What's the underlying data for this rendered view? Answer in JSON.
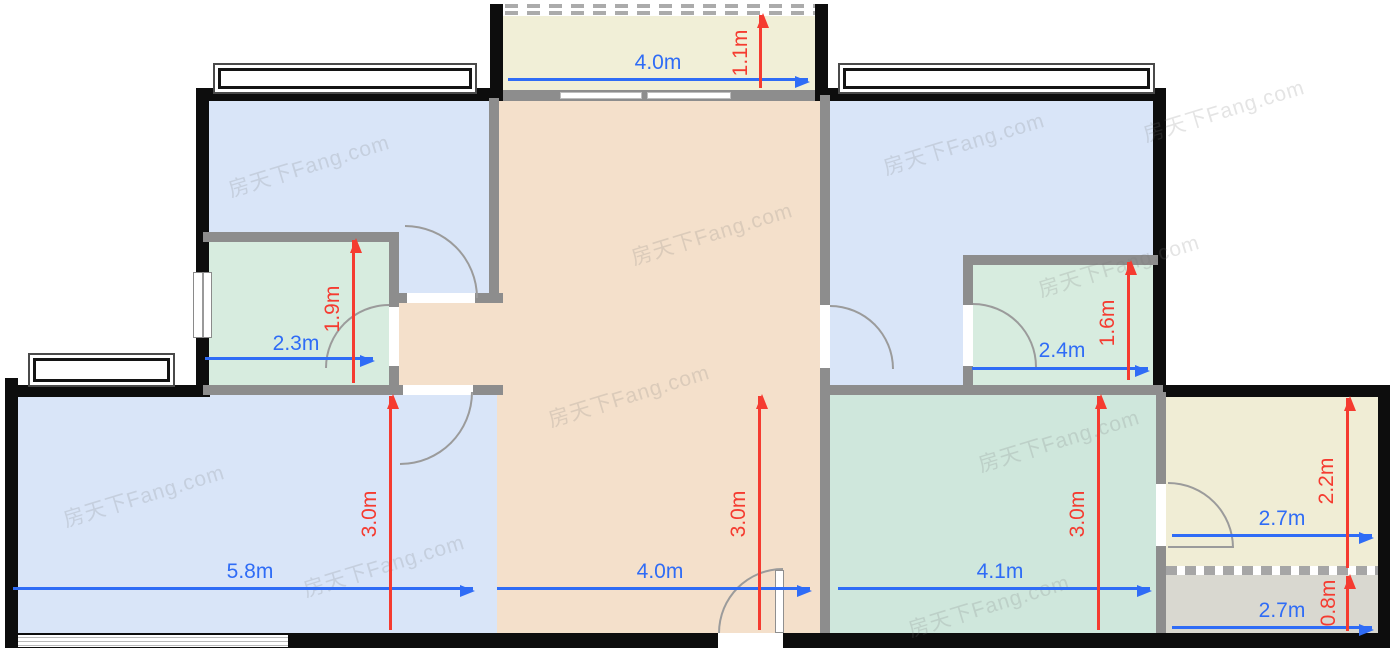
{
  "plan": {
    "watermark_text": "房天下Fang.com",
    "unit": "m",
    "palette": {
      "bedroom_blue": "#d9e5f8",
      "bathroom_green": "#d7ecdf",
      "living_green": "#cfe7dc",
      "hall_orange": "#f4e0cb",
      "balcony_cream": "#f1efd7",
      "kitchen_cream": "#f0edd5",
      "utility_gray": "#d9d8d0",
      "wall_black": "#0d0d0d",
      "wall_gray": "#8d8d8d",
      "dim_horizontal_blue": "#2f6cf6",
      "dim_vertical_red": "#f53b30"
    },
    "rooms": {
      "balcony_top": {
        "width_label": "4.0m",
        "depth_label": "1.1m"
      },
      "bathroom_left": {
        "width_label": "2.3m",
        "depth_label": "1.9m"
      },
      "bathroom_right": {
        "width_label": "2.4m",
        "depth_label": "1.6m"
      },
      "room_bottom_left": {
        "width_label": "5.8m",
        "depth_label": "3.0m"
      },
      "room_center": {
        "width_label": "4.0m",
        "depth_label": "3.0m"
      },
      "room_bottom_right": {
        "width_label": "4.1m",
        "depth_label": "3.0m"
      },
      "kitchen_right": {
        "width_label": "2.7m",
        "depth_label": "2.2m"
      },
      "balcony_bottom_right": {
        "width_label": "2.7m",
        "depth_label": "0.8m"
      }
    }
  }
}
